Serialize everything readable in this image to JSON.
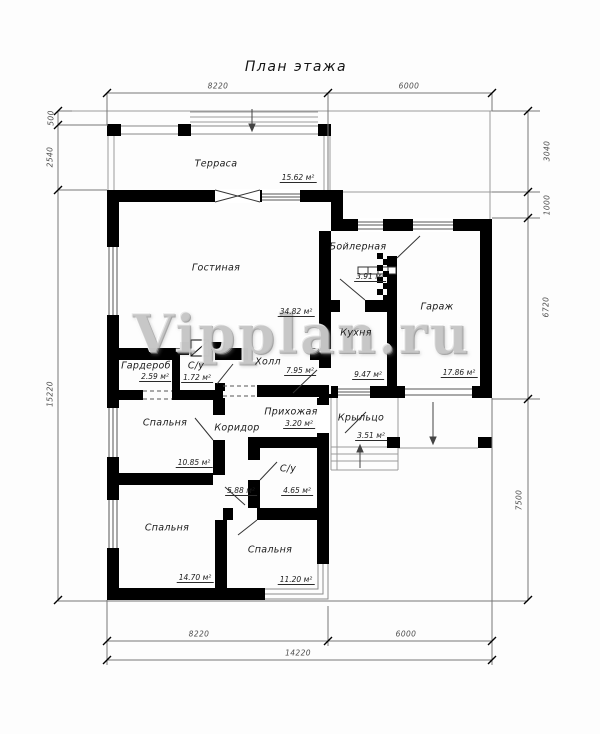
{
  "title": "План этажа",
  "watermark": "Vipplan.ru",
  "rooms": [
    {
      "name": "Терраса",
      "area": "15.62 м²"
    },
    {
      "name": "Гостиная",
      "area": "34.82 м²"
    },
    {
      "name": "Бойлерная",
      "area": "3.91 м²"
    },
    {
      "name": "Гараж",
      "area": "17.86 м²"
    },
    {
      "name": "Кухня",
      "area": "9.47 м²"
    },
    {
      "name": "Холл",
      "area": "7.95 м²"
    },
    {
      "name": "Гардероб",
      "area": "2.59 м²"
    },
    {
      "name": "С/у",
      "area": "1.72 м²"
    },
    {
      "name": "Спальня",
      "area": "10.85 м²"
    },
    {
      "name": "Коридор",
      "area": "5.88 м²"
    },
    {
      "name": "Прихожая",
      "area": "3.20 м²"
    },
    {
      "name": "С/у",
      "area": "4.65 м²"
    },
    {
      "name": "Спальня",
      "area": "14.70 м²"
    },
    {
      "name": "Спальня",
      "area": "11.20 м²"
    },
    {
      "name": "Крыльцо",
      "area": "3.51 м²"
    }
  ],
  "dimensions": {
    "top": [
      "8220",
      "6000"
    ],
    "left": [
      "500",
      "2540",
      "15220"
    ],
    "right": [
      "3040",
      "1000",
      "6720",
      "7500"
    ],
    "bottom": [
      "8220",
      "6000",
      "14220"
    ]
  },
  "colors": {
    "wall": "#000000",
    "thin_line": "#9a9a9a",
    "dim_line": "#555555"
  }
}
